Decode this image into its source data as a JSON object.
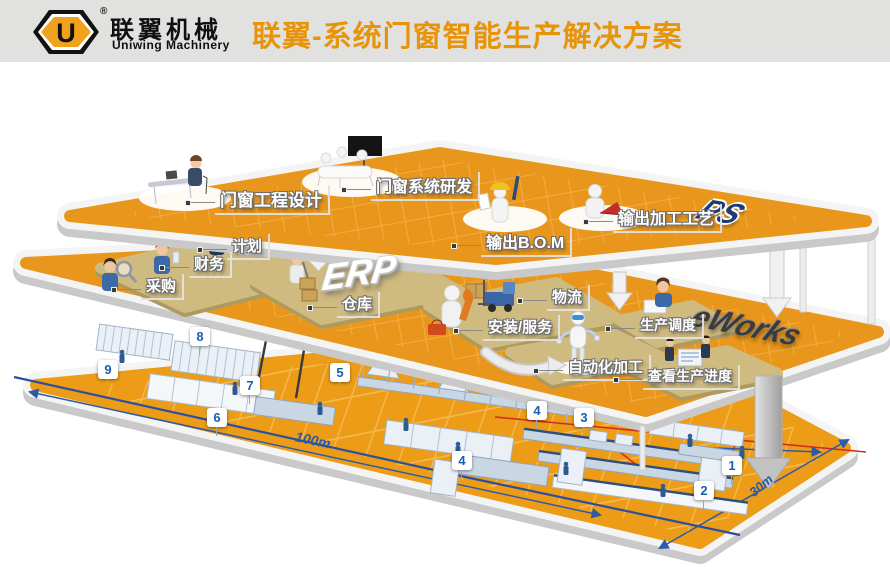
{
  "header": {
    "logo": {
      "symbol": "U",
      "reg": "®",
      "name_zh": "联翼机械",
      "name_en": "Uniwing Machinery"
    },
    "title": "联翼-系统门窗智能生产解决方案"
  },
  "platforms": {
    "design": {
      "system": "PS",
      "stations": [
        {
          "label": "门窗工程设计"
        },
        {
          "label": "门窗系统研发"
        },
        {
          "label": "输出B.O.M"
        },
        {
          "label": "输出加工工艺"
        }
      ]
    },
    "management": {
      "system_erp": "ERP",
      "system_eworks": "eWorks",
      "stations": [
        {
          "label": "计划"
        },
        {
          "label": "财务"
        },
        {
          "label": "采购"
        },
        {
          "label": "仓库"
        },
        {
          "label": "物流"
        },
        {
          "label": "安装/服务"
        },
        {
          "label": "生产调度"
        },
        {
          "label": "自动化加工"
        },
        {
          "label": "查看生产进度"
        }
      ]
    },
    "factory": {
      "dimension_length": "100m",
      "dimension_width": "30m",
      "machine_numbers": [
        "8",
        "9",
        "5",
        "7",
        "6",
        "4",
        "3",
        "4",
        "1",
        "2"
      ]
    }
  },
  "colors": {
    "accent_orange": "#E8940B",
    "platform_orange": "#E8971C",
    "badge_blue": "#1B5EAD",
    "dimension_blue": "#2B5BA8",
    "process_red": "#D22B20"
  }
}
